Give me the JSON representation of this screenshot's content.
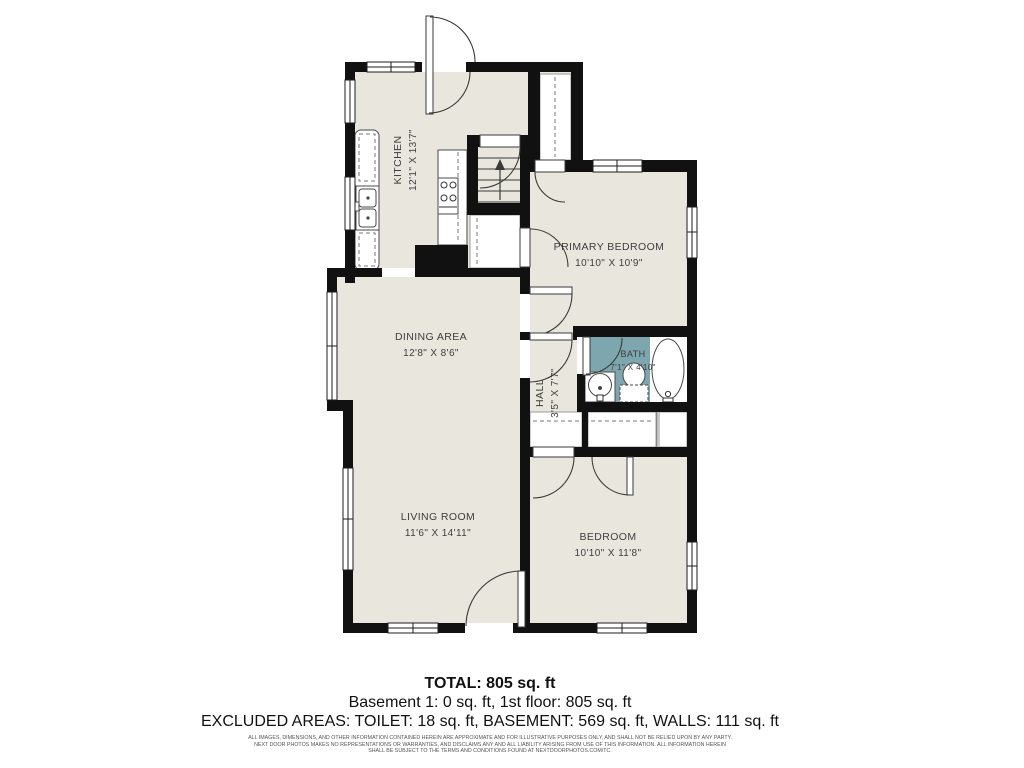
{
  "plan": {
    "rooms": {
      "kitchen": {
        "name": "KITCHEN",
        "dims": "12'1\" X 13'7\""
      },
      "dining": {
        "name": "DINING AREA",
        "dims": "12'8\" X 8'6\""
      },
      "living": {
        "name": "LIVING ROOM",
        "dims": "11'6\" X 14'11\""
      },
      "primary": {
        "name": "PRIMARY BEDROOM",
        "dims": "10'10\" X 10'9\""
      },
      "bath": {
        "name": "BATH",
        "dims": "7'1\" X 4'10\""
      },
      "hall": {
        "name": "HALL",
        "dims": "3'5\" X 7'7\""
      },
      "bedroom": {
        "name": "BEDROOM",
        "dims": "10'10\" X 11'8\""
      }
    },
    "colors": {
      "floor": "#e9e7dd",
      "wall": "#111111",
      "bath_floor": "#7da6af",
      "label_text": "#3d3d3d"
    }
  },
  "summary": {
    "total": "TOTAL: 805 sq. ft",
    "floors": "Basement 1: 0 sq. ft, 1st floor: 805 sq. ft",
    "excluded": "EXCLUDED AREAS: TOILET: 18 sq. ft, BASEMENT: 569 sq. ft, WALLS: 111 sq. ft",
    "disclaimer": {
      "line1": "ALL IMAGES, DIMENSIONS, AND OTHER INFORMATION CONTAINED HEREIN ARE APPROXIMATE AND FOR ILLUSTRATIVE PURPOSES ONLY, AND SHALL NOT BE RELIED UPON BY ANY PARTY.",
      "line2": "NEXT DOOR PHOTOS MAKES NO REPRESENTATIONS OR WARRANTIES, AND DISCLAIMS ANY AND ALL LIABILITY ARISING FROM USE OF THIS INFORMATION. ALL INFORMATION HEREIN",
      "line3": "SHALL BE SUBJECT TO THE TERMS AND CONDITIONS FOUND AT NEXTDOORPHOTOS.COM/TC."
    }
  }
}
